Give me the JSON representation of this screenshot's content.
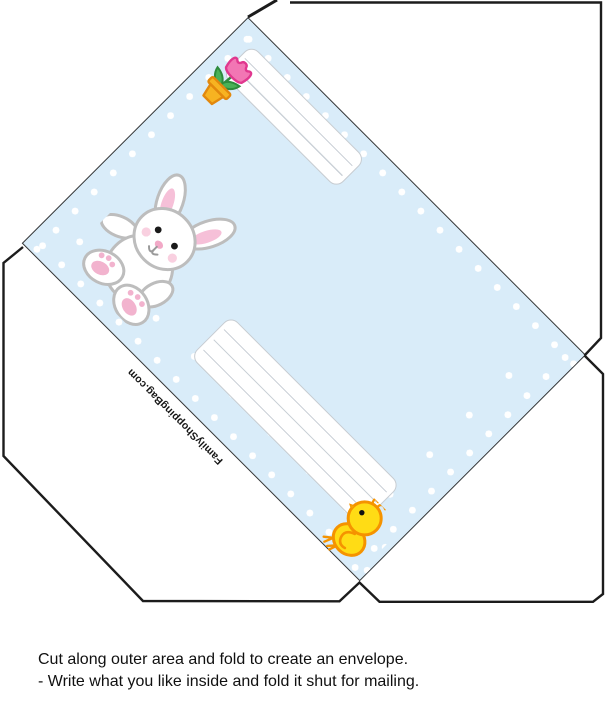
{
  "page": {
    "background_color": "#ffffff",
    "instructions": [
      "Cut along outer area and fold to create an envelope.",
      "- Write what you like inside and fold it shut for mailing."
    ]
  },
  "envelope": {
    "brand_text": "FamilyShoppingBag.com",
    "front_color": "#d9ecf9",
    "dot_color": "#ffffff",
    "cut_outline_color": "#1c1c1c",
    "fold_border_color": "#343434",
    "address_blocks": [
      {
        "id": "upper-address-block",
        "ruled_lines": 2
      },
      {
        "id": "lower-address-block",
        "ruled_lines": 3
      }
    ],
    "illustrations": [
      {
        "id": "tulip-pot",
        "label": "pink tulip in flower pot"
      },
      {
        "id": "easter-bunny",
        "label": "white bunny with pink ears and paws"
      },
      {
        "id": "easter-chick",
        "label": "yellow chick"
      }
    ]
  }
}
